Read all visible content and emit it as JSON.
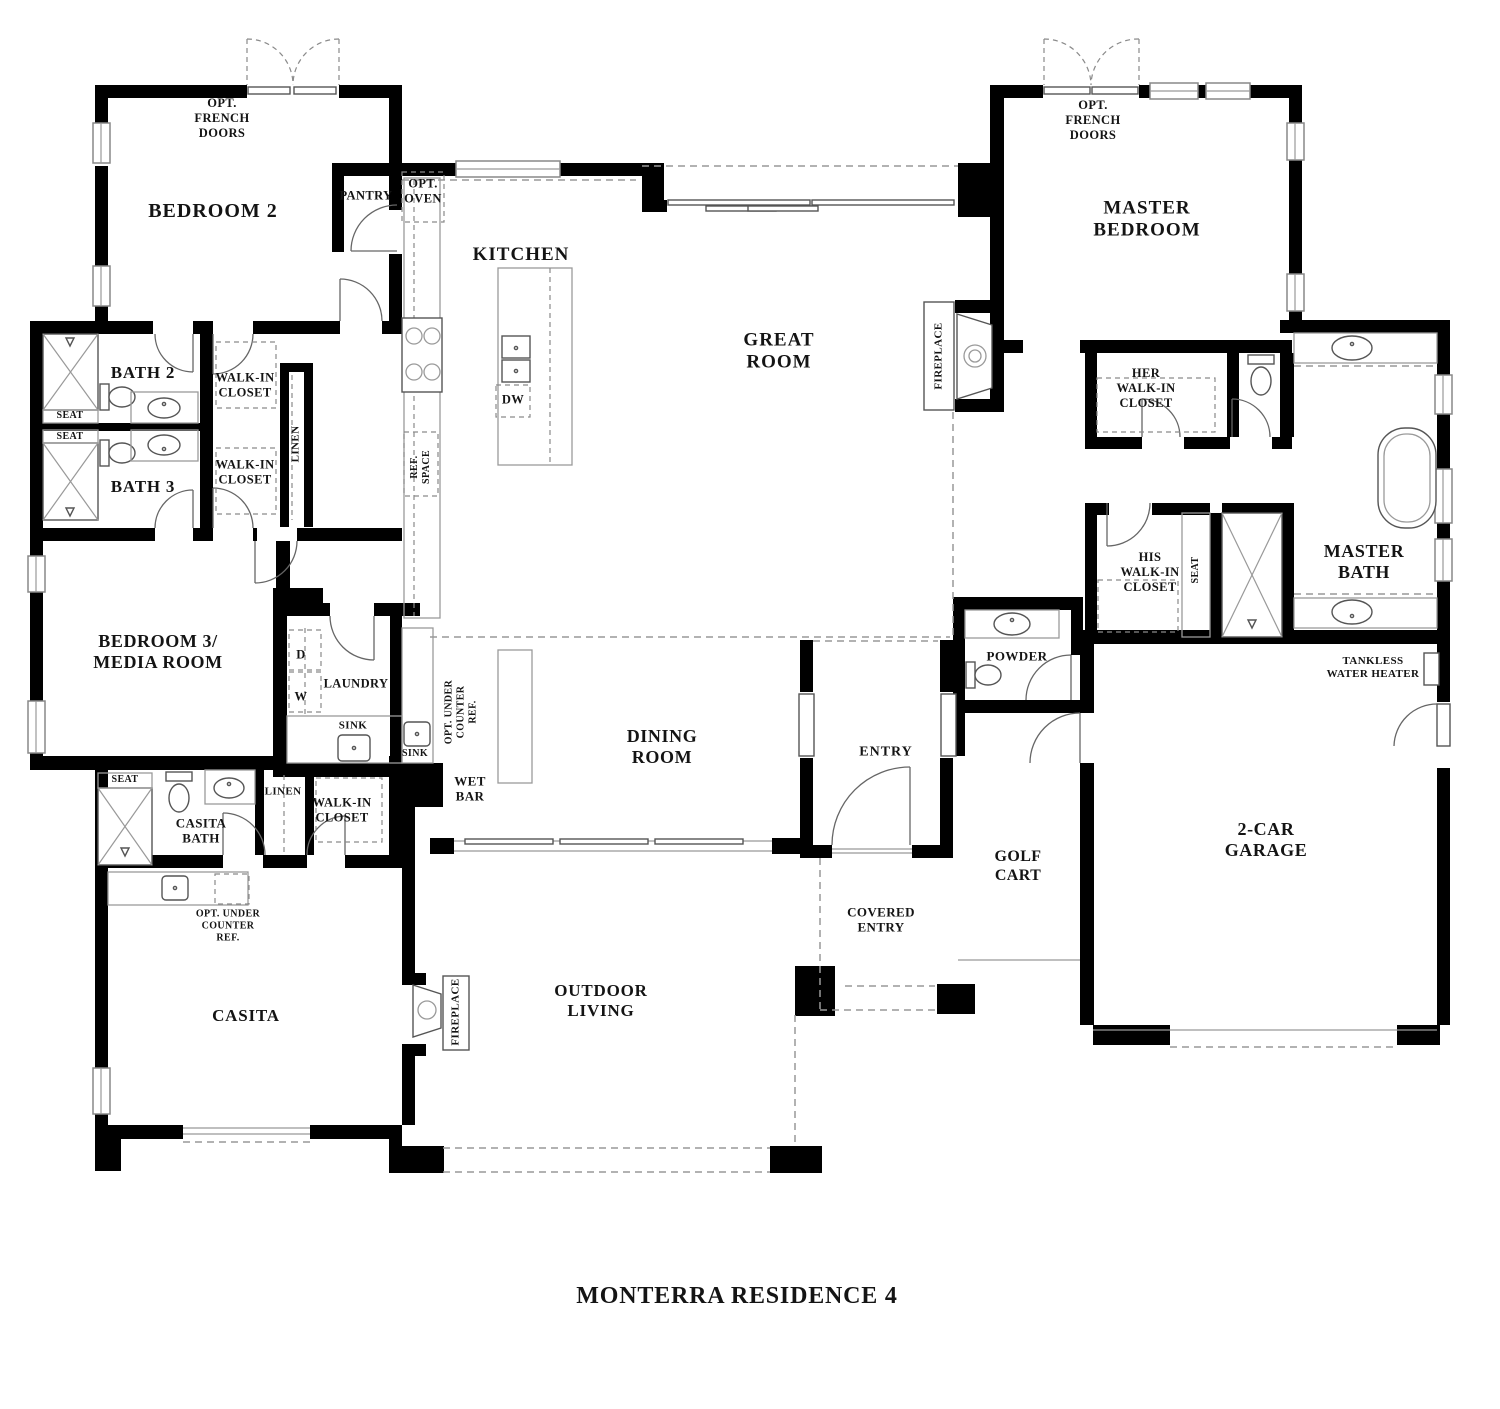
{
  "title": "MONTERRA RESIDENCE 4",
  "rooms": {
    "bedroom2": "BEDROOM 2",
    "bath2": "BATH 2",
    "bath3": "BATH 3",
    "bedroom3": "BEDROOM 3/\nMEDIA ROOM",
    "kitchen": "KITCHEN",
    "pantry": "PANTRY",
    "great_room": "GREAT\nROOM",
    "master_bedroom": "MASTER\nBEDROOM",
    "master_bath": "MASTER\nBATH",
    "her_wic": "HER\nWALK-IN\nCLOSET",
    "his_wic": "HIS\nWALK-IN\nCLOSET",
    "wic_bath2": "WALK-IN\nCLOSET",
    "wic_bath3": "WALK-IN\nCLOSET",
    "wic_casita": "WALK-IN\nCLOSET",
    "dining_room": "DINING\nROOM",
    "laundry": "LAUNDRY",
    "wet_bar": "WET\nBAR",
    "entry": "ENTRY",
    "covered_entry": "COVERED\nENTRY",
    "powder": "POWDER",
    "golf_cart": "GOLF\nCART",
    "garage": "2-CAR\nGARAGE",
    "casita": "CASITA",
    "casita_bath": "CASITA\nBATH",
    "outdoor_living": "OUTDOOR\nLIVING"
  },
  "annotations": {
    "opt_french_doors_left": "OPT.\nFRENCH\nDOORS",
    "opt_french_doors_right": "OPT.\nFRENCH\nDOORS",
    "opt_oven": "OPT.\nOVEN",
    "dw": "DW",
    "ref_space": "REF.\nSPACE",
    "fireplace_great": "FIREPLACE",
    "fireplace_casita": "FIREPLACE",
    "seat_bath2": "SEAT",
    "seat_bath3": "SEAT",
    "seat_master": "SEAT",
    "seat_casita": "SEAT",
    "linen_hall": "LINEN",
    "linen_casita": "LINEN",
    "d": "D",
    "w": "W",
    "sink_laundry": "SINK",
    "sink_wetbar": "SINK",
    "opt_ref_wetbar": "OPT. UNDER\nCOUNTER\nREF.",
    "opt_ref_casita": "OPT. UNDER\nCOUNTER\nREF.",
    "tankless": "TANKLESS\nWATER HEATER"
  }
}
